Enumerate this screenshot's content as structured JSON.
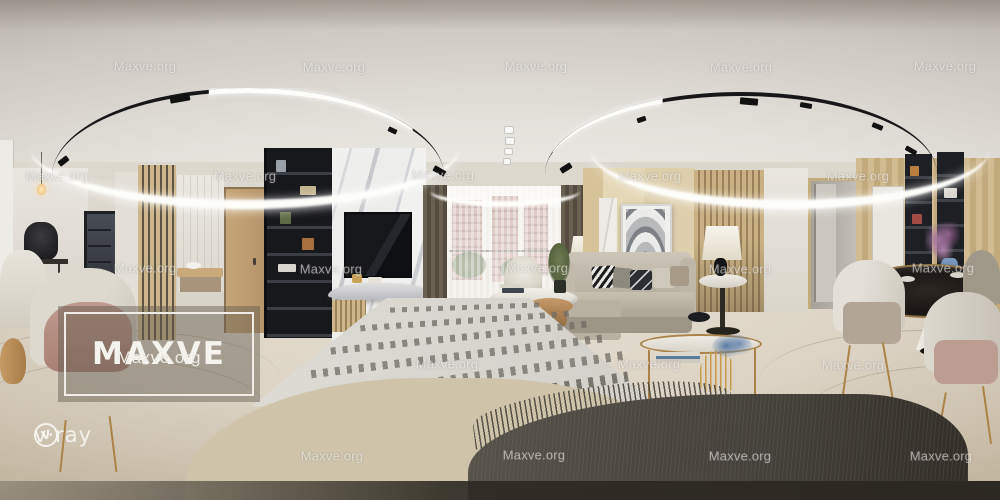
{
  "branding": {
    "watermark": {
      "text": "Maxve.org"
    },
    "logo_box": {
      "title": "MAXVE",
      "subtitle": "Maxve.org"
    },
    "renderer_badge": {
      "symbol": "V",
      "text": "v·ray"
    }
  },
  "watermark_positions": [
    {
      "x": 145,
      "y": 66
    },
    {
      "x": 334,
      "y": 67
    },
    {
      "x": 536,
      "y": 66
    },
    {
      "x": 741,
      "y": 67
    },
    {
      "x": 945,
      "y": 66
    },
    {
      "x": 57,
      "y": 176
    },
    {
      "x": 245,
      "y": 176
    },
    {
      "x": 443,
      "y": 175
    },
    {
      "x": 650,
      "y": 176
    },
    {
      "x": 858,
      "y": 176
    },
    {
      "x": 145,
      "y": 268
    },
    {
      "x": 331,
      "y": 269
    },
    {
      "x": 537,
      "y": 268
    },
    {
      "x": 740,
      "y": 269
    },
    {
      "x": 943,
      "y": 268
    },
    {
      "x": 447,
      "y": 364
    },
    {
      "x": 649,
      "y": 364
    },
    {
      "x": 853,
      "y": 365
    },
    {
      "x": 332,
      "y": 456
    },
    {
      "x": 534,
      "y": 455
    },
    {
      "x": 740,
      "y": 456
    },
    {
      "x": 941,
      "y": 456
    }
  ],
  "palette": {
    "ceiling_center": "#f2f0eb",
    "ceiling_edge": "#a9a29b",
    "wall_white": "#e7e4dd",
    "wood_light": "#cdb68c",
    "wood_dark": "#9a815c",
    "floor_light": "#e6dfd2",
    "floor_dark": "#b9ab92",
    "shelf_dark": "#17181c",
    "curtain": "#554c3f",
    "rug": "#dddbd4",
    "rug_dash": "#6f6c63",
    "table_dark": "#181412",
    "table_dark_hi": "#2c2622",
    "brass": "#ab8348",
    "blanket": "#44403a",
    "tufted": "#cfc4aa",
    "plant_green": "#6f7d53",
    "building": "#c6a39a",
    "track_black": "#17171a",
    "led_white": "#fdfdfa"
  }
}
